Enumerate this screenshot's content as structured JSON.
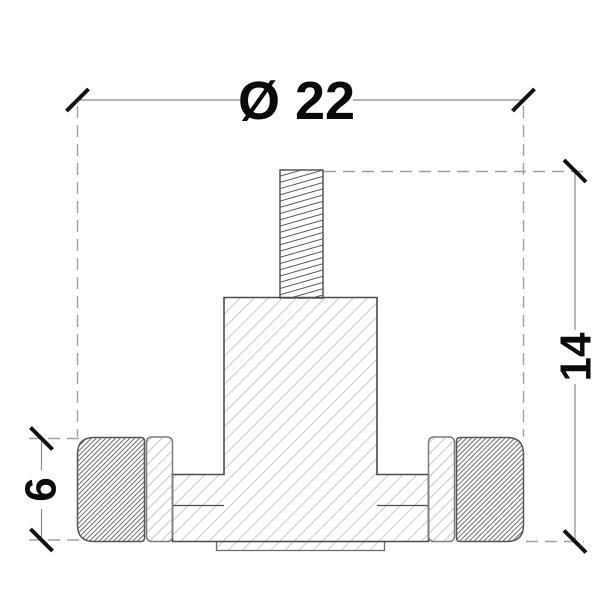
{
  "drawing": {
    "title": "Technical drawing - threaded point fixing adapter cross-section",
    "dimensions": {
      "diameter": "Ø 22",
      "height": "14",
      "thickness": "6"
    },
    "colors": {
      "background": "#ffffff",
      "outline": "#4b4b4b",
      "outline_light": "#7d7d7d",
      "dim_line": "#8a8a8a",
      "dash_line": "#a0a0a0",
      "tick": "#111111",
      "text": "#0a0a0a",
      "hatch_light": "#cacaca",
      "hatch_washer": "#c6c6c6",
      "hatch_dense": "#6e6e6e",
      "hatch_thread": "#5a5a5a"
    }
  }
}
